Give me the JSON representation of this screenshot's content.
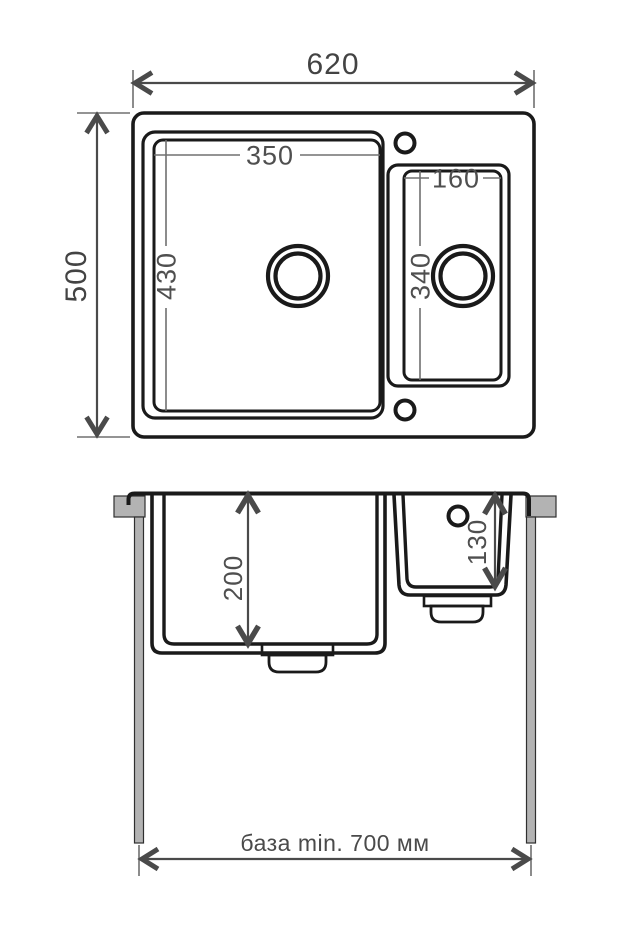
{
  "plan": {
    "overall_width": "620",
    "overall_depth": "500",
    "main_bowl": {
      "width": "350",
      "depth": "430"
    },
    "small_bowl": {
      "width": "160",
      "depth": "340"
    }
  },
  "section": {
    "main_bowl_depth": "200",
    "small_bowl_depth": "130",
    "base_note": "база min. 700 мм"
  },
  "colors": {
    "drawing_line": "#1a1a1a",
    "dimension_line": "#707070",
    "dimension_text": "#4f4f4f",
    "arrow": "#4a4a4a",
    "counter_fill": "#b3b3b3",
    "background": "#ffffff"
  }
}
